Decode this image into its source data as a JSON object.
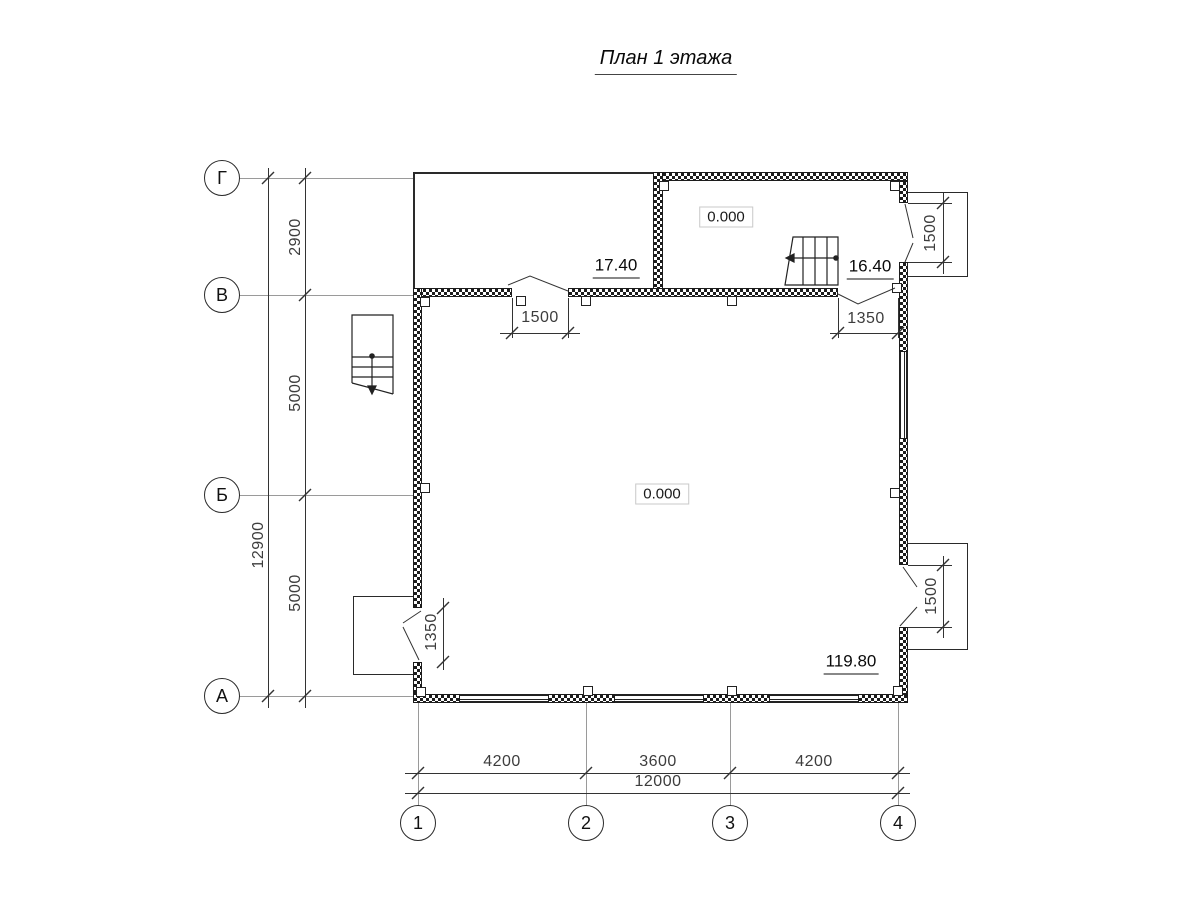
{
  "floor_plan": {
    "title": "План 1 этажа",
    "row_axes": [
      "Г",
      "В",
      "Б",
      "А"
    ],
    "col_axes": [
      "1",
      "2",
      "3",
      "4"
    ],
    "left_dims": {
      "g_v": "2900",
      "v_b": "5000",
      "b_a": "5000",
      "total": "12900"
    },
    "bottom_dims": {
      "d12": "4200",
      "d23": "3600",
      "d34": "4200",
      "total": "12000"
    },
    "opening_dims": {
      "door_v_wall_left": "1500",
      "door_v_wall_right": "1350",
      "door_right_top": "1500",
      "door_right_bottom": "1500",
      "door_left_bottom": "1350"
    },
    "level_marks": {
      "upper_room": "0.000",
      "main_room": "0.000"
    },
    "elevation_marks": {
      "terrace": "17.40",
      "upper_room": "16.40",
      "main_room": "119.80"
    },
    "colors": {
      "line": "#1c1c1c",
      "dim_text": "#3d3d3d",
      "axis_line": "#9a9a9a"
    }
  }
}
